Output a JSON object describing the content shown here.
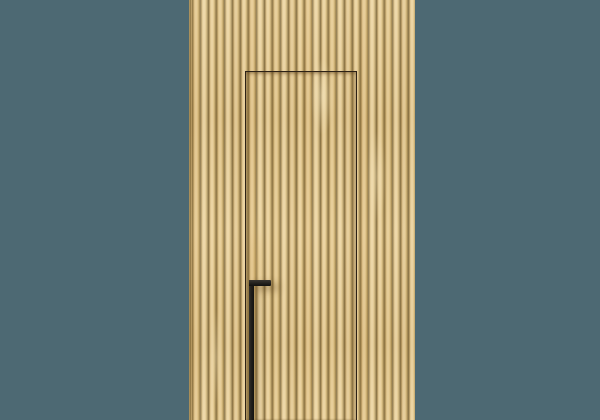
{
  "scene": {
    "title": "Concealed flush door in a vertical wood-slat wall with a black pull handle, on a plain teal backdrop",
    "background_color": "#4d6973",
    "panel": {
      "left": 189,
      "top": 0,
      "width": 226,
      "height": 420,
      "slat_pitch": 8,
      "groove_offset": 3,
      "colors": {
        "base": "#e6cc96",
        "face": "#e9d09b",
        "face_alt": "#e2c78c",
        "highlight": "#eed7a6",
        "groove": "#8c7546",
        "groove_edge": "#c2a56c"
      }
    },
    "door": {
      "left": 245,
      "top": 71,
      "width": 112,
      "height": 349,
      "seam_color": "#2c2115"
    },
    "handle": {
      "shape": "inverted-L pull bar",
      "color": "#22201d",
      "bar": {
        "left": 248.5,
        "top": 280,
        "width": 5,
        "height": 140
      },
      "cap": {
        "left": 248.5,
        "top": 280,
        "width": 22,
        "height": 6
      }
    }
  }
}
